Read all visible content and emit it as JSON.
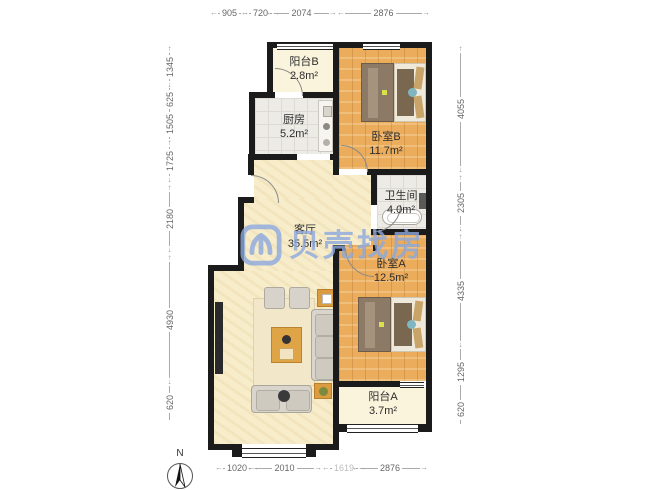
{
  "watermark": {
    "text": "贝壳找房",
    "color": "#8CA9DE"
  },
  "compass": {
    "north_label": "N"
  },
  "rooms": {
    "balcony_b": {
      "name": "阳台B",
      "area": "2.8m²"
    },
    "kitchen": {
      "name": "厨房",
      "area": "5.2m²"
    },
    "bedroom_b": {
      "name": "卧室B",
      "area": "11.7m²"
    },
    "bathroom": {
      "name": "卫生间",
      "area": "4.0m²"
    },
    "living": {
      "name": "客厅",
      "area": "35.5m²"
    },
    "bedroom_a": {
      "name": "卧室A",
      "area": "12.5m²"
    },
    "balcony_a": {
      "name": "阳台A",
      "area": "3.7m²"
    }
  },
  "dimensions": {
    "top": [
      "905",
      "720",
      "2074",
      "2876"
    ],
    "bottom": [
      "1020",
      "2010",
      "1619",
      "2876"
    ],
    "left": [
      "1345",
      "625",
      "1505",
      "1725",
      "2180",
      "4930",
      "620"
    ],
    "right": [
      "4055",
      "2305",
      "4335",
      "1295",
      "620"
    ]
  }
}
